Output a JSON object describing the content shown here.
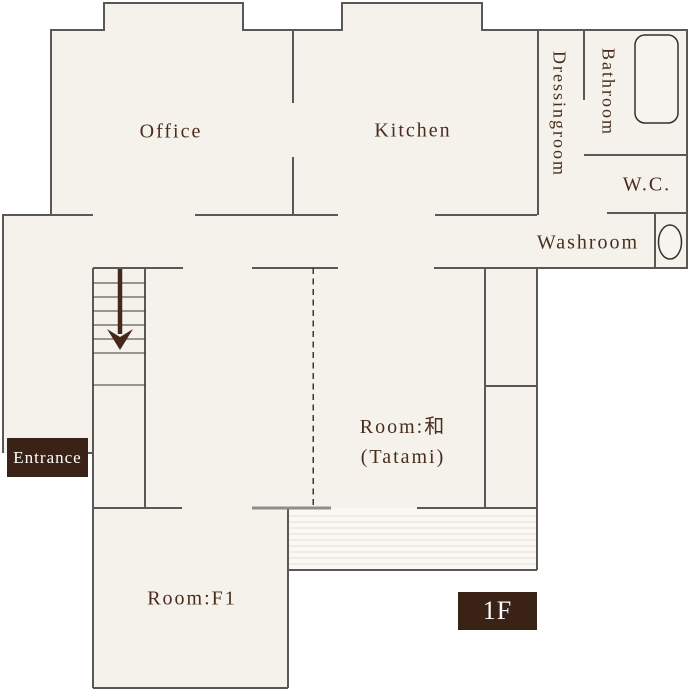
{
  "plan": {
    "type": "floor-plan",
    "floor": "1F",
    "colors": {
      "interior_fill": "#f5f2ec",
      "engawa_fill": "#faf8f4",
      "wall": "#5a5757",
      "sliding_door": "#8f8c8a",
      "stair_line": "#3a3633",
      "engawa_line": "#e8ddcf",
      "label_text": "#4a2d1e",
      "badge_bg": "#3a2316",
      "badge_text": "#ffffff",
      "arrow": "#46281a"
    },
    "rooms": {
      "office": {
        "label": "Office"
      },
      "kitchen": {
        "label": "Kitchen"
      },
      "dressingroom": {
        "label": "Dressingroom"
      },
      "bathroom": {
        "label": "Bathroom"
      },
      "wc": {
        "label": "W.C."
      },
      "washroom": {
        "label": "Washroom"
      },
      "tatami": {
        "label_line1": "Room:和",
        "label_line2": "(Tatami)"
      },
      "room_f1": {
        "label": "Room:F1"
      }
    },
    "badges": {
      "entrance": {
        "label": "Entrance"
      },
      "floor": {
        "label": "1F"
      }
    },
    "icons": {
      "bathtub": "rounded-rectangle outline",
      "toilet": "ellipse outline",
      "stairs_down_arrow": "↓ long down arrow",
      "partition": "vertical dashed line"
    }
  }
}
